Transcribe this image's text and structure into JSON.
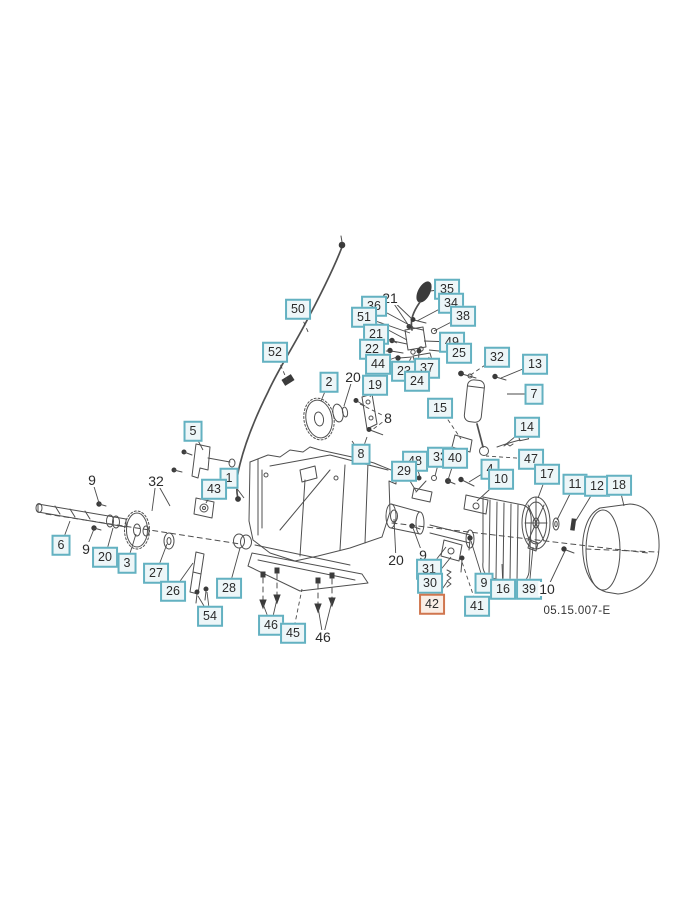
{
  "page": {
    "width": 688,
    "height": 900,
    "background": "#ffffff",
    "part_code": "05.15.007-E"
  },
  "colors": {
    "box_border": "#63b1c1",
    "box_fill": "#edf6f8",
    "highlight_border": "#d0764f",
    "highlight_fill": "#faeee6",
    "label_text": "#2b2b2b",
    "drawing_line": "#4f4f4f",
    "leader_line": "#4a4a4a"
  },
  "labels": [
    {
      "text": "50",
      "x": 298,
      "y": 309,
      "variant": "box",
      "dash": true,
      "targets": [
        [
          309,
          334
        ]
      ]
    },
    {
      "text": "52",
      "x": 275,
      "y": 352,
      "variant": "box",
      "dash": true,
      "targets": [
        [
          287,
          380
        ]
      ]
    },
    {
      "text": "21",
      "x": 390,
      "y": 298,
      "variant": "plain",
      "targets": [
        [
          412,
          319
        ],
        [
          409,
          326
        ]
      ]
    },
    {
      "text": "36",
      "x": 374,
      "y": 306,
      "variant": "box",
      "targets": [
        [
          413,
          327
        ]
      ]
    },
    {
      "text": "51",
      "x": 364,
      "y": 317,
      "variant": "box",
      "targets": [
        [
          410,
          333
        ],
        [
          407,
          340
        ]
      ]
    },
    {
      "text": "35",
      "x": 447,
      "y": 289,
      "variant": "box",
      "targets": [
        [
          430,
          291
        ]
      ]
    },
    {
      "text": "34",
      "x": 451,
      "y": 303,
      "variant": "box",
      "targets": [
        [
          417,
          321
        ]
      ]
    },
    {
      "text": "38",
      "x": 463,
      "y": 316,
      "variant": "box",
      "targets": [
        [
          434,
          331
        ]
      ]
    },
    {
      "text": "49",
      "x": 452,
      "y": 342,
      "variant": "box",
      "targets": [
        [
          424,
          341
        ]
      ]
    },
    {
      "text": "25",
      "x": 459,
      "y": 353,
      "variant": "box",
      "targets": [
        [
          429,
          350
        ]
      ]
    },
    {
      "text": "21",
      "x": 376,
      "y": 334,
      "variant": "box",
      "targets": [
        [
          397,
          343
        ]
      ]
    },
    {
      "text": "22",
      "x": 372,
      "y": 349,
      "variant": "box",
      "dash": true,
      "targets": [
        [
          393,
          352
        ]
      ]
    },
    {
      "text": "44",
      "x": 378,
      "y": 364,
      "variant": "box",
      "targets": [
        [
          397,
          357
        ]
      ]
    },
    {
      "text": "23",
      "x": 404,
      "y": 371,
      "variant": "box",
      "targets": [
        [
          411,
          358
        ]
      ]
    },
    {
      "text": "37",
      "x": 427,
      "y": 368,
      "variant": "box",
      "targets": [
        [
          429,
          357
        ]
      ]
    },
    {
      "text": "24",
      "x": 417,
      "y": 381,
      "variant": "box",
      "targets": [
        [
          420,
          364
        ]
      ]
    },
    {
      "text": "2",
      "x": 329,
      "y": 382,
      "variant": "box",
      "targets": [
        [
          321,
          401
        ]
      ]
    },
    {
      "text": "20",
      "x": 353,
      "y": 377,
      "variant": "plain",
      "targets": [
        [
          344,
          406
        ]
      ]
    },
    {
      "text": "19",
      "x": 375,
      "y": 385,
      "variant": "box",
      "targets": [
        [
          370,
          397
        ]
      ]
    },
    {
      "text": "8",
      "x": 388,
      "y": 418,
      "variant": "plain",
      "dash": true,
      "targets": [
        [
          372,
          430
        ],
        [
          360,
          404
        ]
      ]
    },
    {
      "text": "8",
      "x": 361,
      "y": 454,
      "variant": "box",
      "targets": [
        [
          367,
          437
        ],
        [
          352,
          441
        ]
      ]
    },
    {
      "text": "32",
      "x": 497,
      "y": 357,
      "variant": "box",
      "dash": true,
      "targets": [
        [
          469,
          376
        ]
      ]
    },
    {
      "text": "13",
      "x": 535,
      "y": 364,
      "variant": "box",
      "targets": [
        [
          501,
          378
        ]
      ]
    },
    {
      "text": "7",
      "x": 534,
      "y": 394,
      "variant": "box",
      "targets": [
        [
          507,
          394
        ]
      ]
    },
    {
      "text": "15",
      "x": 440,
      "y": 408,
      "variant": "box",
      "dash": true,
      "targets": [
        [
          461,
          439
        ]
      ]
    },
    {
      "text": "14",
      "x": 527,
      "y": 427,
      "variant": "box",
      "targets": [
        [
          505,
          445
        ]
      ]
    },
    {
      "text": "47",
      "x": 531,
      "y": 459,
      "variant": "box",
      "dash": true,
      "targets": [
        [
          486,
          456
        ]
      ]
    },
    {
      "text": "48",
      "x": 415,
      "y": 461,
      "variant": "box",
      "targets": [
        [
          420,
          477
        ]
      ]
    },
    {
      "text": "33",
      "x": 440,
      "y": 457,
      "variant": "box",
      "targets": [
        [
          435,
          476
        ]
      ]
    },
    {
      "text": "40",
      "x": 455,
      "y": 458,
      "variant": "box",
      "targets": [
        [
          448,
          480
        ]
      ]
    },
    {
      "text": "29",
      "x": 404,
      "y": 471,
      "variant": "box",
      "targets": [
        [
          416,
          491
        ]
      ]
    },
    {
      "text": "4",
      "x": 490,
      "y": 469,
      "variant": "box",
      "targets": [
        [
          469,
          482
        ]
      ]
    },
    {
      "text": "10",
      "x": 501,
      "y": 479,
      "variant": "box",
      "targets": [
        [
          477,
          501
        ]
      ]
    },
    {
      "text": "17",
      "x": 547,
      "y": 474,
      "variant": "box",
      "targets": [
        [
          538,
          498
        ]
      ]
    },
    {
      "text": "11",
      "x": 575,
      "y": 484,
      "variant": "box",
      "targets": [
        [
          557,
          520
        ]
      ]
    },
    {
      "text": "12",
      "x": 597,
      "y": 486,
      "variant": "box",
      "targets": [
        [
          575,
          522
        ]
      ]
    },
    {
      "text": "18",
      "x": 619,
      "y": 485,
      "variant": "box",
      "targets": [
        [
          624,
          506
        ]
      ]
    },
    {
      "text": "1",
      "x": 229,
      "y": 478,
      "variant": "box",
      "targets": [
        [
          244,
          498
        ]
      ]
    },
    {
      "text": "43",
      "x": 214,
      "y": 489,
      "variant": "box",
      "targets": [
        [
          206,
          503
        ]
      ]
    },
    {
      "text": "5",
      "x": 193,
      "y": 431,
      "variant": "box",
      "targets": [
        [
          203,
          450
        ]
      ]
    },
    {
      "text": "9",
      "x": 92,
      "y": 480,
      "variant": "plain",
      "targets": [
        [
          99,
          503
        ]
      ]
    },
    {
      "text": "32",
      "x": 156,
      "y": 481,
      "variant": "plain",
      "targets": [
        [
          170,
          506
        ],
        [
          152,
          511
        ]
      ]
    },
    {
      "text": "6",
      "x": 61,
      "y": 545,
      "variant": "box",
      "targets": [
        [
          70,
          521
        ]
      ]
    },
    {
      "text": "9",
      "x": 86,
      "y": 549,
      "variant": "plain",
      "targets": [
        [
          94,
          529
        ]
      ]
    },
    {
      "text": "20",
      "x": 105,
      "y": 557,
      "variant": "box",
      "targets": [
        [
          113,
          528
        ]
      ]
    },
    {
      "text": "3",
      "x": 127,
      "y": 563,
      "variant": "box",
      "targets": [
        [
          136,
          534
        ]
      ]
    },
    {
      "text": "27",
      "x": 156,
      "y": 573,
      "variant": "box",
      "targets": [
        [
          167,
          544
        ]
      ]
    },
    {
      "text": "26",
      "x": 173,
      "y": 591,
      "variant": "box",
      "targets": [
        [
          193,
          563
        ]
      ]
    },
    {
      "text": "28",
      "x": 229,
      "y": 588,
      "variant": "box",
      "targets": [
        [
          240,
          548
        ]
      ]
    },
    {
      "text": "54",
      "x": 210,
      "y": 616,
      "variant": "box",
      "targets": [
        [
          198,
          596
        ],
        [
          207,
          592
        ]
      ]
    },
    {
      "text": "46",
      "x": 271,
      "y": 625,
      "variant": "box",
      "targets": [
        [
          263,
          604
        ],
        [
          277,
          599
        ]
      ]
    },
    {
      "text": "45",
      "x": 293,
      "y": 633,
      "variant": "box",
      "dash": true,
      "targets": [
        [
          302,
          589
        ]
      ]
    },
    {
      "text": "46",
      "x": 323,
      "y": 637,
      "variant": "plain",
      "targets": [
        [
          318,
          607
        ],
        [
          332,
          601
        ]
      ]
    },
    {
      "text": "20",
      "x": 396,
      "y": 560,
      "variant": "plain",
      "targets": [
        [
          394,
          519
        ]
      ]
    },
    {
      "text": "9",
      "x": 423,
      "y": 555,
      "variant": "plain",
      "targets": [
        [
          413,
          528
        ]
      ]
    },
    {
      "text": "31",
      "x": 429,
      "y": 569,
      "variant": "box",
      "targets": [
        [
          446,
          547
        ]
      ]
    },
    {
      "text": "30",
      "x": 430,
      "y": 583,
      "variant": "box",
      "targets": [
        [
          451,
          557
        ]
      ]
    },
    {
      "text": "42",
      "x": 432,
      "y": 604,
      "variant": "highlight",
      "targets": [
        [
          447,
          582
        ]
      ]
    },
    {
      "text": "41",
      "x": 477,
      "y": 606,
      "variant": "box",
      "dash": true,
      "targets": [
        [
          462,
          562
        ]
      ]
    },
    {
      "text": "9",
      "x": 484,
      "y": 583,
      "variant": "box",
      "targets": [
        [
          471,
          541
        ]
      ]
    },
    {
      "text": "16",
      "x": 503,
      "y": 589,
      "variant": "box",
      "targets": [
        [
          502,
          564
        ]
      ]
    },
    {
      "text": "39",
      "x": 529,
      "y": 589,
      "variant": "box",
      "targets": [
        [
          533,
          547
        ]
      ]
    },
    {
      "text": "10",
      "x": 547,
      "y": 589,
      "variant": "plain",
      "targets": [
        [
          565,
          551
        ]
      ]
    }
  ]
}
